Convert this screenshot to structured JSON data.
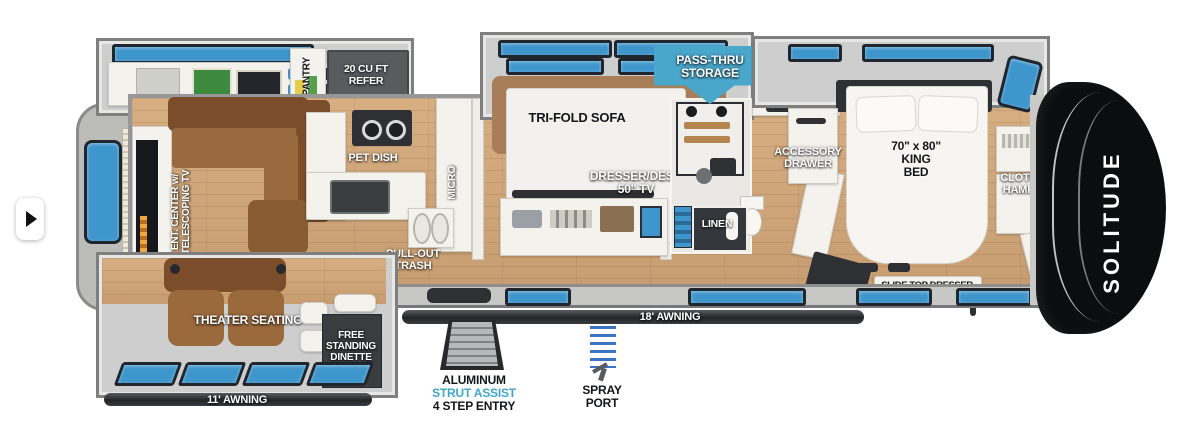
{
  "page": {
    "background": "#ffffff"
  },
  "carousel": {
    "direction": "next"
  },
  "floorplan": {
    "brand": {
      "model": "SOLITUDE"
    },
    "colors": {
      "banner_blue": "#4AA7CC",
      "window_blue": "#3F96CC",
      "strut_text_blue": "#3FA6C9",
      "floor_wood": "#D0A87C",
      "slide_gray": "#CDCECD",
      "cap_black": "#0C0D0F",
      "awning_dark": "#27292C"
    },
    "living": {
      "ent_center": "ENT. CENTER w/\nTELESCOPING TV",
      "electronics_drawer": "ELECTRONICS\nDRAWER",
      "theater_seating": "THEATER SEATING",
      "dinette": "FREE\nSTANDING\nDINETTE",
      "awning_rear": "11' AWNING"
    },
    "kitchen": {
      "pantry": "PANTRY",
      "refer": "20 CU FT\nREFER",
      "pet_dish": "PET DISH",
      "micro": "MICRO",
      "pull_out_trash": "PULL-OUT\nTRASH"
    },
    "middle_room": {
      "tri_fold_sofa": "TRI-FOLD SOFA",
      "dresser_desk": "DRESSER/DESK\n50\" TV"
    },
    "bath": {
      "linen": "LINEN"
    },
    "bedroom": {
      "accessory_drawer": "ACCESSORY\nDRAWER",
      "king_bed": "70\" x 80\"\nKING\nBED",
      "slide_top_dresser": "SLIDE TOP DRESSER",
      "clothes_hamper": "CLOTHES\nHAMPER",
      "washer_dryer": "WASHER/\nDRYER\nPREP"
    },
    "exterior": {
      "pass_thru": "PASS-THRU\nSTORAGE",
      "awning_main": "18' AWNING",
      "entry_line1": "ALUMINUM",
      "entry_line2": "STRUT ASSIST",
      "entry_line3": "4 STEP ENTRY",
      "spray_port": "SPRAY\nPORT"
    }
  }
}
